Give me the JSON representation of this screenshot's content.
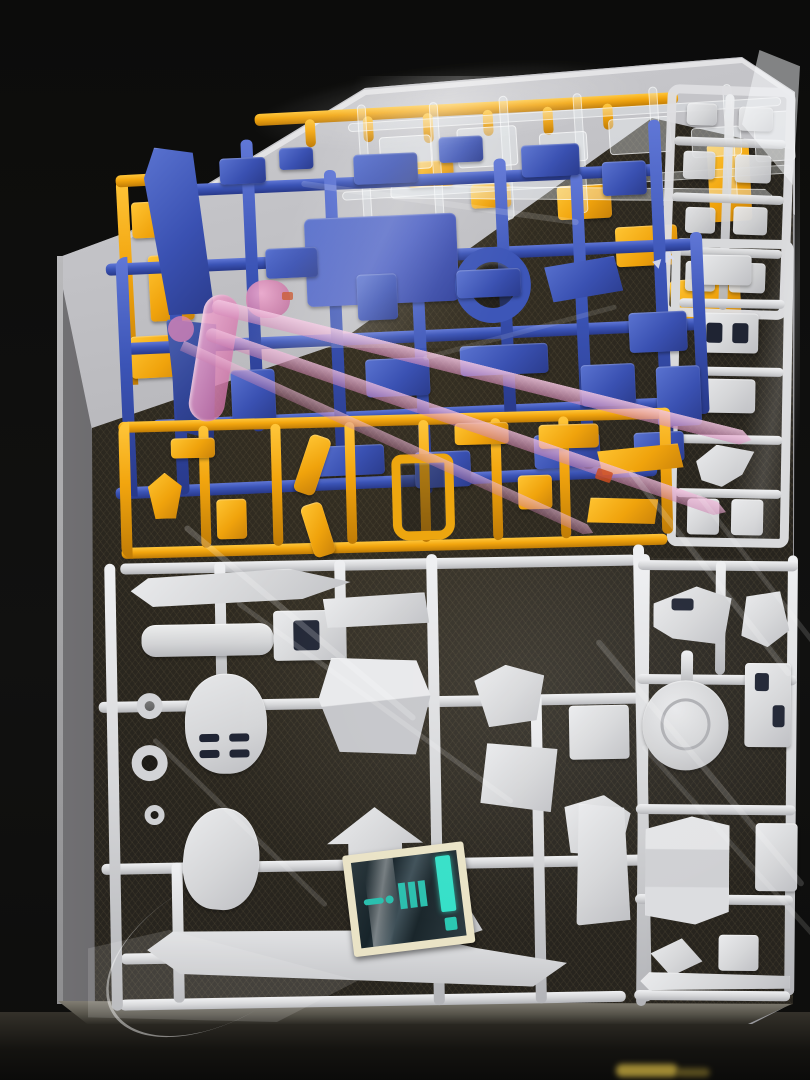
{
  "scene": {
    "subject": "Opened model-kit box photographed from above, containing bagged plastic part runners",
    "runner_letter": "A",
    "palette": {
      "background": "#0c0c0b",
      "box_wall": "#b4b4b8",
      "box_floor": "#27251f",
      "blue_runner": "#3b54b6",
      "yellow_runner": "#f2a50e",
      "white_runner": "#d6d7d9",
      "clear_runner": "#eef2f6",
      "clear_pink_parts": "#e294c1",
      "sticker_backing": "#eae3c6",
      "sticker_foil": "#223036",
      "sticker_accent": "#35e0c8",
      "table_glint": "#c3a83e"
    },
    "runners": [
      {
        "id": "clear-parts-runner",
        "color_name": "clear"
      },
      {
        "id": "yellow-runner",
        "color_name": "yellow-orange"
      },
      {
        "id": "blue-runner",
        "color_name": "blue",
        "letter": "A"
      },
      {
        "id": "clear-pink-blade-parts",
        "color_name": "translucent pink"
      },
      {
        "id": "white-small-parts-runner",
        "color_name": "off-white"
      },
      {
        "id": "white-runner-right-column",
        "color_name": "light gray"
      },
      {
        "id": "white-runner-bottom-left",
        "color_name": "light gray"
      },
      {
        "id": "white-runner-bottom-right",
        "color_name": "light gray"
      }
    ],
    "extras": [
      "metallic foil sticker sheet with teal accents",
      "clear plastic bags covering runners"
    ]
  }
}
